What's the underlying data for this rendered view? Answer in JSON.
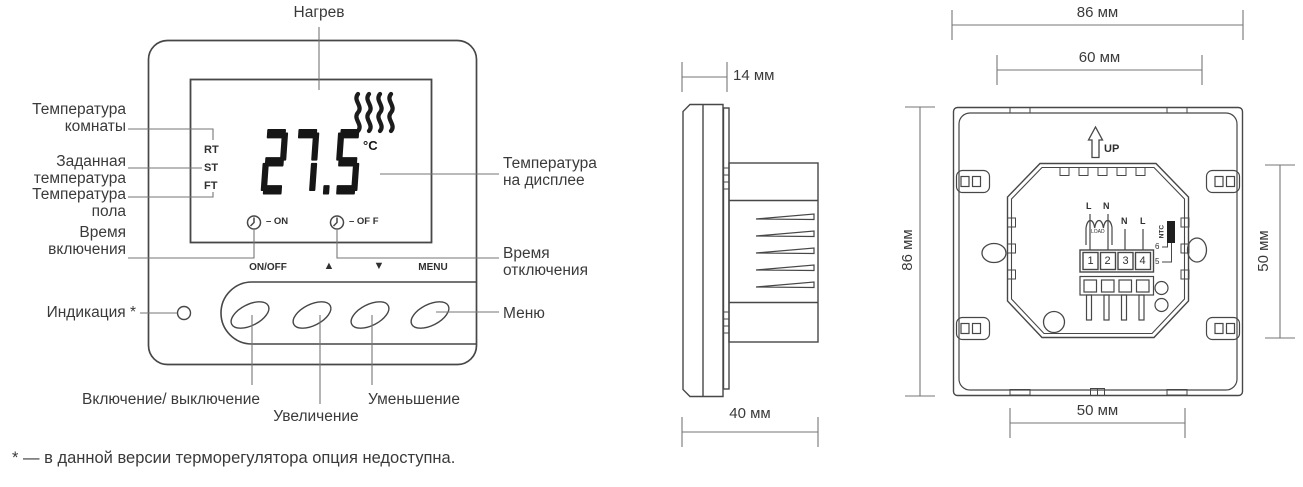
{
  "colors": {
    "ink": "#3a3a3a",
    "device_line": "#474747",
    "callout_line": "#767676",
    "digit": "#161616",
    "ntc_block": "#1f1f1f"
  },
  "front": {
    "callouts": {
      "heating": "Нагрев",
      "room_temp": "Температура комнаты",
      "set_temp": "Заданная температура",
      "floor_temp": "Температура пола",
      "on_time": "Время включения",
      "indication": "Индикация *",
      "display_temp": "Температура на дисплее",
      "off_time": "Время отключения",
      "menu": "Меню",
      "power": "Включение/ выключение",
      "increase": "Увеличение",
      "decrease": "Уменьшение"
    },
    "display": {
      "modes": [
        "RT",
        "ST",
        "FT"
      ],
      "value": "27.5",
      "unit": "°C",
      "on_label": "– ON",
      "off_label": "– OF F"
    },
    "buttons": {
      "on_off": "ON/OFF",
      "up": "▲",
      "down": "▼",
      "menu": "MENU"
    }
  },
  "side": {
    "width_label": "14 мм",
    "depth_label": "40 мм"
  },
  "back": {
    "up_label": "UP",
    "dims": {
      "outer_width": "86 мм",
      "inner_width": "60 мм",
      "height": "86 мм",
      "octagon_height": "50 мм",
      "bottom_width": "50 мм"
    },
    "terminals": [
      "1",
      "2",
      "3",
      "4"
    ],
    "wiring": {
      "load_l": "L",
      "load_n": "N",
      "load": "LOAD",
      "sense_n": "N",
      "sense_l": "L",
      "ntc": "NTC",
      "t6": "6",
      "t5": "5"
    }
  },
  "footnote": "* — в данной версии терморегулятора опция недоступна."
}
